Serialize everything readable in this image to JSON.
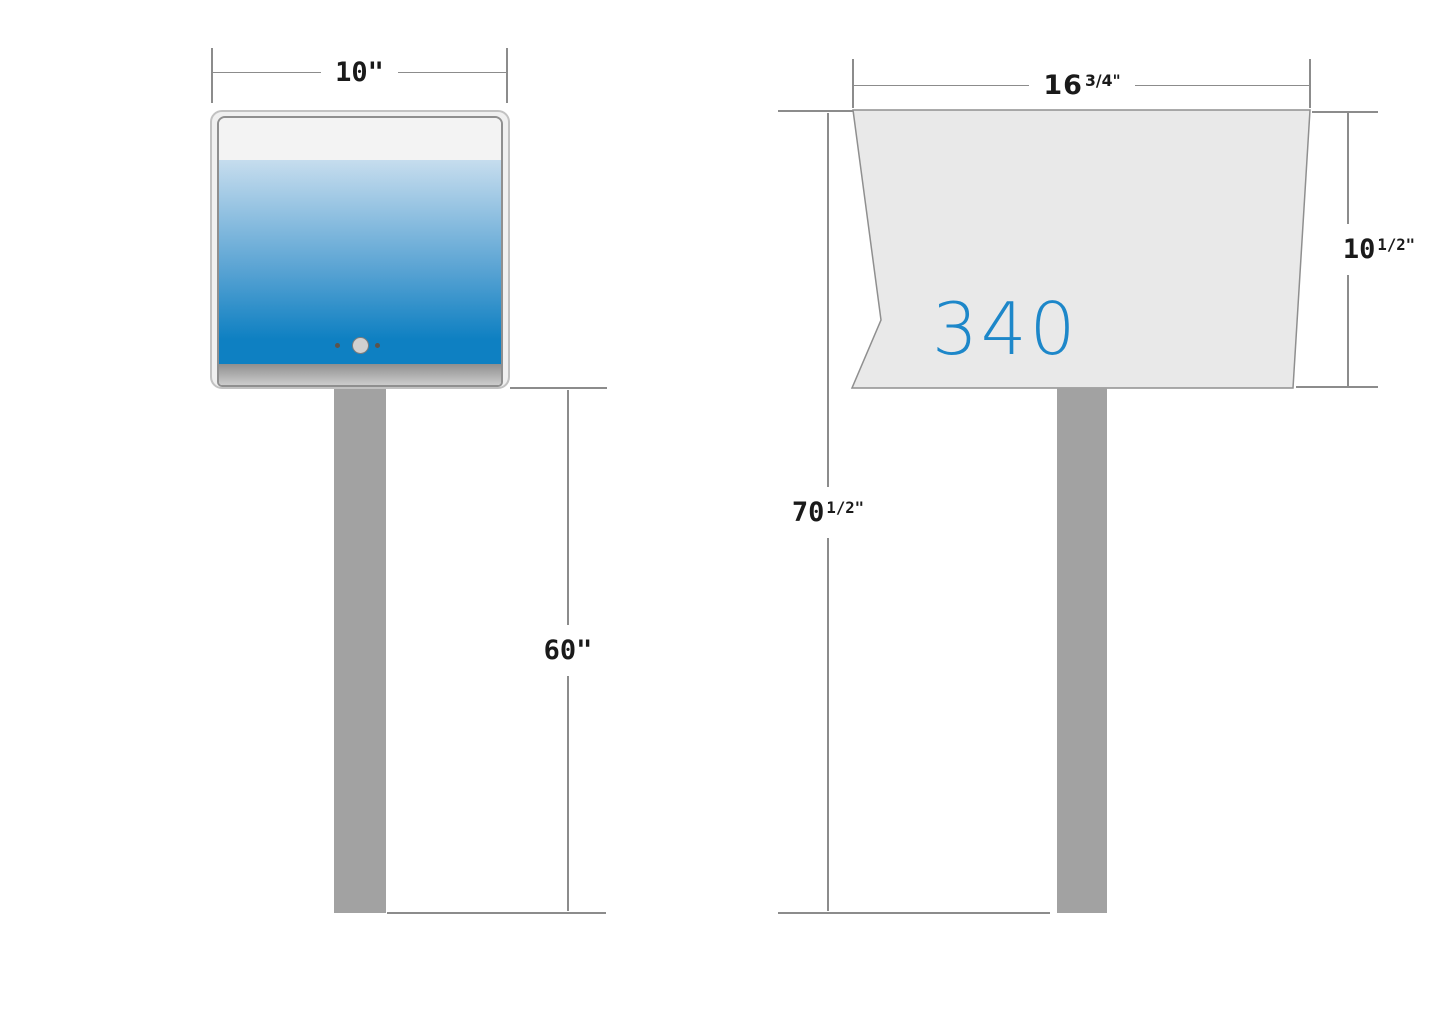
{
  "colors": {
    "dimension_line": "#8c8c8c",
    "dimension_text": "#1a1a1a",
    "side_box_fill": "#e9e9e9",
    "side_box_stroke": "#8f8f8f",
    "front_outer_fill": "#f0f0f0",
    "front_outer_stroke": "#c2c2c2",
    "front_inner_stroke": "#8f8f8f",
    "front_top_band": "#f3f3f3",
    "blue_top": "#c6ddee",
    "blue_mid": "#5da5d4",
    "blue_bottom": "#0e80c2",
    "base_strip_top": "#8f8f8f",
    "base_strip_bottom": "#cccccc",
    "post_fill": "#a2a2a2",
    "knob_fill": "#d0d0d0",
    "knob_stroke": "#7c7c7c",
    "dot_fill": "#5b544c",
    "house_number": "#1d87c9"
  },
  "front_view": {
    "width_dim_label": "10\"",
    "height_dim_label": "60\""
  },
  "side_view": {
    "house_number": "340",
    "width_dim_base": "16",
    "width_dim_sup": "3/4\"",
    "depth_dim_base": "10",
    "depth_dim_sup": "1/2\"",
    "total_height_dim_base": "70",
    "total_height_dim_sup": "1/2\""
  }
}
